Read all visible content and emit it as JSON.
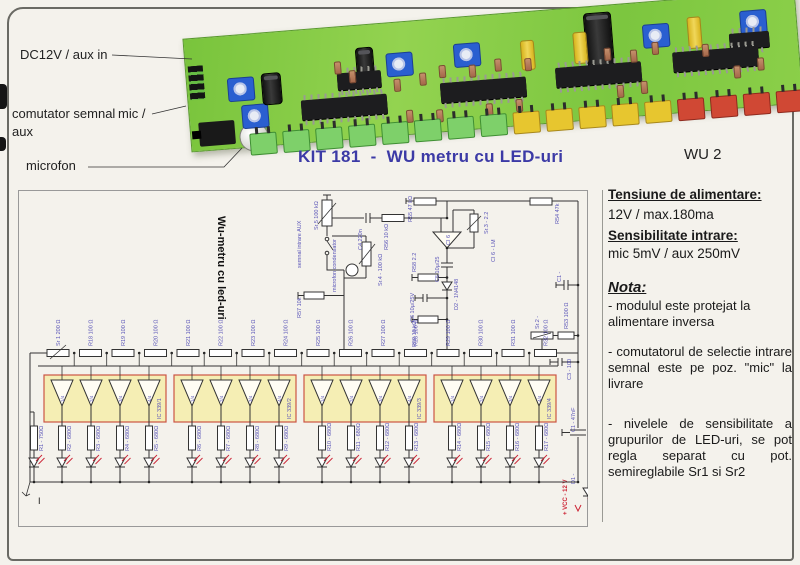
{
  "photo": {
    "labels": {
      "dc12v": "DC12V / aux in",
      "comutator": "comutator semnal",
      "comutator2": "mic /",
      "comutator3": "aux",
      "microfon": "microfon"
    }
  },
  "title": {
    "main": "KIT 181  -  WU metru cu LED-uri",
    "right": "WU 2"
  },
  "colors": {
    "title_purple": "#3c3aa6",
    "label_purple": "#5a55b8",
    "accent_red": "#cc3333",
    "pcb_green": "#7cc63f",
    "group_fill": "#f5eeb4",
    "group_border": "#cc5544"
  },
  "pcb": {
    "leds": [
      "green",
      "green",
      "green",
      "green",
      "green",
      "green",
      "green",
      "green",
      "yellow",
      "yellow",
      "yellow",
      "yellow",
      "yellow",
      "red",
      "red",
      "red",
      "red"
    ]
  },
  "schematic": {
    "vertical_title": "Wu-metru cu led-uri",
    "labels": {
      "sr5": "Sr.5  100 kΩ",
      "semnal": "semnal intrare AUX",
      "microfon": "microfon condensator",
      "sr4": "Sr.4 - 100 kΩ",
      "c4": "C4 220n",
      "r56": "R56 10 kΩ",
      "r55": "R55 47 kΩ",
      "r54": "R54 47k",
      "ci6": "CI 6",
      "sr3": "Sr.3 - 2.2",
      "ci6lm": "CI 6 - LM",
      "r58": "R58 2.2",
      "c5": "C5 10μ/25",
      "d2": "D2 - 1N4148",
      "c6": "C6 10μ/25V",
      "r59": "R59 18 kΩ",
      "r57": "R57 10k",
      "c1a": "C1 -",
      "sr2": "Sr.2 -",
      "r53": "R53 100 Ω",
      "c3": "C3 - 100",
      "c1b": "C1 - 47nF",
      "d1": "D1 -",
      "vcc": "+ VCC - 12 V",
      "gnd": "I"
    },
    "ladder": [
      "Sr 1 200 Ω",
      "R18 100 Ω",
      "R19 100 Ω",
      "R20 100 Ω",
      "R21 100 Ω",
      "R22 100 Ω",
      "R23 100 Ω",
      "R24 100 Ω",
      "R25 100 Ω",
      "R26 100 Ω",
      "R27 100 Ω",
      "R28 100 Ω",
      "R29 100 Ω",
      "R30 100 Ω",
      "R31 100 Ω",
      "R32 100 Ω"
    ],
    "groups": [
      {
        "ic": "IC 339/1",
        "amps": [
          "1/4",
          "2/4",
          "3/4",
          "4/4"
        ]
      },
      {
        "ic": "IC 339/2",
        "amps": [
          "1/4",
          "2/4",
          "3/4",
          "4/4"
        ]
      },
      {
        "ic": "IC 339/3",
        "amps": [
          "1/4",
          "2/4",
          "3/4",
          "4/4"
        ]
      },
      {
        "ic": "IC 339/4",
        "amps": [
          "1/4",
          "2/4",
          "3/4",
          "4/4"
        ]
      }
    ],
    "outputs": [
      "R1 - 750Ω",
      "R2 - 680Ω",
      "R3 - 680Ω",
      "R4 - 680Ω",
      "R5 - 680Ω",
      "R6 - 680Ω",
      "R7 - 680Ω",
      "R8 - 680Ω",
      "R9 - 680Ω",
      "R10 - 680Ω",
      "R11 - 680Ω",
      "R12 - 680Ω",
      "R13 - 680Ω",
      "R14 - 680Ω",
      "R15 - 680Ω",
      "R16 - 680Ω",
      "R17 - 680Ω"
    ]
  },
  "info": {
    "supply_title": "Tensiune de alimentare:",
    "supply_value": "12V / max.180ma",
    "sens_title": "Sensibilitate intrare:",
    "sens_value": "mic 5mV / aux 250mV",
    "nota_title": "Nota:",
    "notes": [
      "- modulul este protejat la alimentare inversa",
      "- comutatorul de selectie intrare semnal este pe poz. \"mic\" la livrare",
      "- nivelele de sensibilitate a grupurilor de LED-uri, se pot regla separat cu pot. semireglabile Sr1 si Sr2"
    ]
  }
}
